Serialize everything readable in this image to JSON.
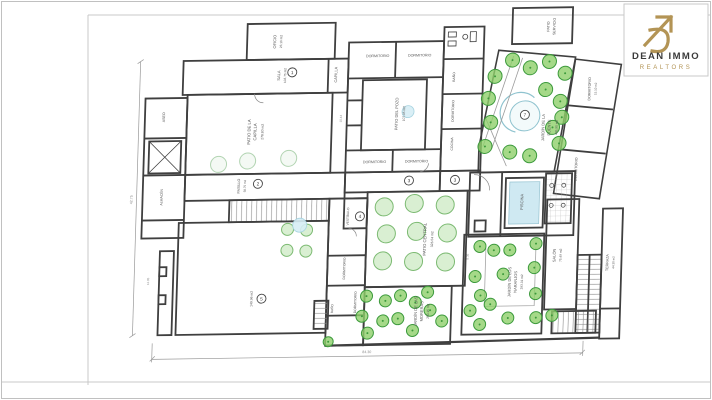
{
  "brand": {
    "name": "DEAN IMMO",
    "tagline": "REALTORS",
    "logo_color": "#b39455",
    "name_color": "#3a3a3a"
  },
  "colors": {
    "wall": "#3f3f3f",
    "frame_line": "#c9c9c9",
    "dim": "#8a8a8a",
    "water_fill": "#d6edf5",
    "water_stroke": "#a6d3e0",
    "tree_kinds": {
      "b": {
        "f": "#8ed06a",
        "s": "#3c9a3c",
        "o": 0.8,
        "dot": true
      },
      "m": {
        "f": "#d9efd2",
        "s": "#7cba72",
        "o": 1,
        "dot": false
      },
      "p": {
        "f": "#f4f9f4",
        "s": "#b2d4b2",
        "o": 1,
        "dot": false
      }
    }
  },
  "plan": {
    "room_numbers": [
      {
        "n": "1",
        "x": 289,
        "y": 71
      },
      {
        "n": "2",
        "x": 258,
        "y": 182
      },
      {
        "n": "3",
        "x": 409,
        "y": 181
      },
      {
        "n": "3",
        "x": 455,
        "y": 181
      },
      {
        "n": "4",
        "x": 361,
        "y": 216
      },
      {
        "n": "5",
        "x": 265,
        "y": 297
      },
      {
        "n": "7",
        "x": 523,
        "y": 117
      }
    ],
    "labels": [
      {
        "t": "OFICIO",
        "x": 272,
        "y": 40,
        "r": -90,
        "s": 4
      },
      {
        "t": "23.10 m2",
        "x": 278,
        "y": 40,
        "r": -90,
        "s": 3.2
      },
      {
        "t": "SALA",
        "x": 277,
        "y": 74,
        "r": -90,
        "s": 4
      },
      {
        "t": "103.75 m2",
        "x": 283,
        "y": 74,
        "r": -90,
        "s": 3.2
      },
      {
        "t": "CAPILLA",
        "x": 334,
        "y": 74,
        "r": -90,
        "s": 3.8
      },
      {
        "t": "PATIO DE LA",
        "x": 249,
        "y": 130,
        "r": -90,
        "s": 4.2
      },
      {
        "t": "CAPILLA",
        "x": 255,
        "y": 130,
        "r": -90,
        "s": 4.2
      },
      {
        "t": "278.80 m2",
        "x": 262,
        "y": 130,
        "r": -90,
        "s": 3.4
      },
      {
        "t": "ASEO",
        "x": 163,
        "y": 114,
        "r": -90,
        "s": 3.6
      },
      {
        "t": "ALMACÉN",
        "x": 163,
        "y": 194,
        "r": -90,
        "s": 3.4
      },
      {
        "t": "PASILLO",
        "x": 240,
        "y": 184,
        "r": -90,
        "s": 3.6
      },
      {
        "t": "58.75 m2",
        "x": 246,
        "y": 184,
        "r": -90,
        "s": 3
      },
      {
        "t": "149.96 m2",
        "x": 256,
        "y": 297,
        "r": -90,
        "s": 3.4
      },
      {
        "t": "DORMITORIO",
        "x": 374,
        "y": 57,
        "r": 0,
        "s": 3.6
      },
      {
        "t": "DORMITORIO",
        "x": 416,
        "y": 57,
        "r": 0,
        "s": 3.6
      },
      {
        "t": "DORMITORIO",
        "x": 374,
        "y": 163,
        "r": 0,
        "s": 3.6
      },
      {
        "t": "DORMITORIO",
        "x": 416,
        "y": 163,
        "r": 0,
        "s": 3.6
      },
      {
        "t": "PATIO DEL POZO",
        "x": 396,
        "y": 114,
        "r": -90,
        "s": 4
      },
      {
        "t": "107.05 m2",
        "x": 403,
        "y": 114,
        "r": -90,
        "s": 3.2
      },
      {
        "t": "BAÑO",
        "x": 452,
        "y": 78,
        "r": -90,
        "s": 3.4
      },
      {
        "t": "DORMITORIO",
        "x": 452,
        "y": 112,
        "r": -90,
        "s": 3.4
      },
      {
        "t": "COCINA",
        "x": 452,
        "y": 145,
        "r": -90,
        "s": 3.4
      },
      {
        "t": "PATIO",
        "x": 545,
        "y": 29,
        "r": -90,
        "s": 3.6
      },
      {
        "t": "SERVICIO",
        "x": 551,
        "y": 29,
        "r": -90,
        "s": 3.6
      },
      {
        "t": "JARDÍN DE LA",
        "x": 543,
        "y": 130,
        "r": -90,
        "s": 4
      },
      {
        "t": "FUENTE",
        "x": 549,
        "y": 130,
        "r": -90,
        "s": 4
      },
      {
        "t": "495.90 m2",
        "x": 556,
        "y": 130,
        "r": -90,
        "s": 3.2
      },
      {
        "t": "DORMITORIO",
        "x": 588,
        "y": 92,
        "r": -90,
        "s": 3.6
      },
      {
        "t": "15.10 m2",
        "x": 594,
        "y": 92,
        "r": -90,
        "s": 3
      },
      {
        "t": "DORMITORIO",
        "x": 577,
        "y": 172,
        "r": -90,
        "s": 3.6
      },
      {
        "t": "PISCINA",
        "x": 524,
        "y": 204,
        "r": -90,
        "s": 4
      },
      {
        "t": "PATIO CENTRAL",
        "x": 428,
        "y": 240,
        "r": -90,
        "s": 4.2
      },
      {
        "t": "326.04 m2",
        "x": 435,
        "y": 240,
        "r": -90,
        "s": 3.4
      },
      {
        "t": "VESTÍBULO",
        "x": 350,
        "y": 216,
        "r": -90,
        "s": 3.2
      },
      {
        "t": "DORMITORIO",
        "x": 348,
        "y": 268,
        "r": -90,
        "s": 3.4
      },
      {
        "t": "DORMITORIO",
        "x": 360,
        "y": 302,
        "r": -90,
        "s": 3.4
      },
      {
        "t": "BAÑO",
        "x": 337,
        "y": 308,
        "r": -90,
        "s": 3.2
      },
      {
        "t": "JARDÍN DE LAS",
        "x": 421,
        "y": 312,
        "r": -90,
        "s": 4
      },
      {
        "t": "MORERAS",
        "x": 427,
        "y": 312,
        "r": -90,
        "s": 4
      },
      {
        "t": "250.15 m2",
        "x": 433,
        "y": 312,
        "r": -90,
        "s": 3.2
      },
      {
        "t": "JARDÍN DE LOS",
        "x": 514,
        "y": 284,
        "r": -90,
        "s": 4
      },
      {
        "t": "NARANJOS",
        "x": 520,
        "y": 284,
        "r": -90,
        "s": 4
      },
      {
        "t": "293.01 m2",
        "x": 526,
        "y": 284,
        "r": -90,
        "s": 3.2
      },
      {
        "t": "SALÓN",
        "x": 558,
        "y": 258,
        "r": -90,
        "s": 4
      },
      {
        "t": "75.49 m2",
        "x": 564,
        "y": 258,
        "r": -90,
        "s": 3.2
      },
      {
        "t": "TERRAZA",
        "x": 611,
        "y": 266,
        "r": -90,
        "s": 3.6
      },
      {
        "t": "44.30 m2",
        "x": 617,
        "y": 266,
        "r": -90,
        "s": 3
      },
      {
        "t": "12.05",
        "x": 152,
        "y": 278,
        "r": -90,
        "s": 3,
        "c": "#8a8a8a"
      },
      {
        "t": "10.44",
        "x": 340,
        "y": 118,
        "r": -90,
        "s": 3,
        "c": "#8a8a8a"
      },
      {
        "t": "8.35",
        "x": 471,
        "y": 258,
        "r": -90,
        "s": 3,
        "c": "#8a8a8a"
      }
    ],
    "dimensions": [
      {
        "t": "84.30",
        "x": 372,
        "y": 353,
        "r": 0
      },
      {
        "t": "42.75",
        "x": 133,
        "y": 196,
        "r": -90
      }
    ],
    "trees": [
      [
        492,
        78,
        7,
        "b"
      ],
      [
        486,
        100,
        7,
        "b"
      ],
      [
        489,
        124,
        7,
        "b"
      ],
      [
        484,
        148,
        7,
        "b"
      ],
      [
        509,
        62,
        7,
        "b"
      ],
      [
        527,
        70,
        7,
        "b"
      ],
      [
        546,
        64,
        7,
        "b"
      ],
      [
        562,
        76,
        7,
        "b"
      ],
      [
        543,
        92,
        7,
        "b"
      ],
      [
        558,
        104,
        7,
        "b"
      ],
      [
        560,
        120,
        7,
        "b"
      ],
      [
        551,
        130,
        7,
        "b"
      ],
      [
        558,
        146,
        7,
        "b"
      ],
      [
        509,
        154,
        7,
        "b"
      ],
      [
        529,
        158,
        7,
        "b"
      ],
      [
        482,
        248,
        6,
        "b"
      ],
      [
        496,
        252,
        6,
        "b"
      ],
      [
        478,
        278,
        6,
        "b"
      ],
      [
        484,
        297,
        6,
        "b"
      ],
      [
        474,
        312,
        6,
        "b"
      ],
      [
        494,
        306,
        6,
        "b"
      ],
      [
        506,
        276,
        6,
        "b"
      ],
      [
        512,
        252,
        6,
        "b"
      ],
      [
        538,
        246,
        6,
        "b"
      ],
      [
        537,
        270,
        6,
        "b"
      ],
      [
        539,
        296,
        6,
        "b"
      ],
      [
        556,
        318,
        6,
        "b"
      ],
      [
        540,
        320,
        6,
        "b"
      ],
      [
        512,
        320,
        6,
        "b"
      ],
      [
        484,
        326,
        6,
        "b"
      ],
      [
        370,
        296,
        6,
        "b"
      ],
      [
        366,
        316,
        6,
        "b"
      ],
      [
        372,
        333,
        6,
        "b"
      ],
      [
        389,
        301,
        6,
        "b"
      ],
      [
        387,
        321,
        6,
        "b"
      ],
      [
        404,
        296,
        6,
        "b"
      ],
      [
        402,
        319,
        6,
        "b"
      ],
      [
        419,
        303,
        6,
        "b"
      ],
      [
        417,
        331,
        6,
        "b"
      ],
      [
        434,
        311,
        6,
        "b"
      ],
      [
        431,
        293,
        6,
        "b"
      ],
      [
        446,
        322,
        6,
        "b"
      ],
      [
        333,
        341,
        5,
        "b"
      ],
      [
        385,
        207,
        9,
        "m"
      ],
      [
        415,
        204,
        9,
        "m"
      ],
      [
        446,
        206,
        9,
        "m"
      ],
      [
        388,
        234,
        9,
        "m"
      ],
      [
        418,
        232,
        9,
        "m"
      ],
      [
        449,
        234,
        9,
        "m"
      ],
      [
        385,
        261,
        9,
        "m"
      ],
      [
        416,
        262,
        9,
        "m"
      ],
      [
        448,
        263,
        9,
        "m"
      ],
      [
        218,
        162,
        8,
        "p"
      ],
      [
        247,
        159,
        8,
        "p"
      ],
      [
        288,
        157,
        8,
        "p"
      ],
      [
        289,
        228,
        6,
        "m"
      ],
      [
        308,
        229,
        6,
        "m"
      ],
      [
        289,
        249,
        6,
        "m"
      ],
      [
        308,
        250,
        6,
        "m"
      ]
    ],
    "water": [
      {
        "x": 406,
        "y": 112,
        "r": 6
      },
      {
        "x": 301,
        "y": 224,
        "r": 7
      }
    ]
  }
}
